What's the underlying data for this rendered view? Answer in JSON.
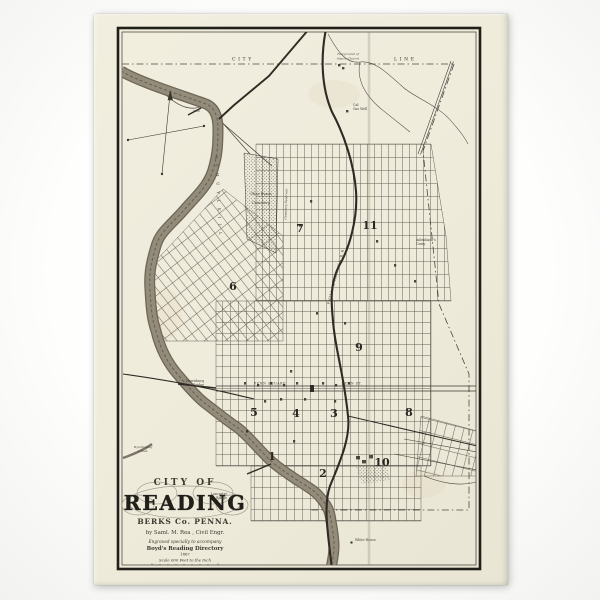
{
  "cartouche": {
    "pretitle": "CITY OF",
    "title": "READING",
    "subtitle": "BERKS Co. PENNA.",
    "byline": "by Saml. M. Rea , Civil Engr.",
    "engraved": "Engraved specially to accompany",
    "directory": "Boyd's Reading Directory",
    "year": "1867",
    "scale": "Scale 600 Feet to the Inch"
  },
  "boundary": {
    "city": "CITY",
    "line": "LINE"
  },
  "wards": {
    "w1": "1",
    "w2": "2",
    "w3": "3",
    "w4": "4",
    "w5": "5",
    "w6": "6",
    "w7": "7",
    "w8": "8",
    "w9": "9",
    "w10": "10",
    "w11": "11"
  },
  "labels": {
    "river": "S C H U Y L K I L L",
    "dam": "Dam",
    "fairground1": "Fairground of",
    "fairground2": "Alsace Church",
    "gas1": "Cal.",
    "gas2": "Gas Well",
    "cemetery1": "Chas Evans",
    "cemetery2": "Cemetery",
    "cemetery_reservoir": "Cemetery Reservoir",
    "aulenbach1": "Aulenbach's",
    "aulenbach2": "Cemy",
    "railroad": "PHILA. & READING R.R.",
    "penn_square": "PENN SQUARE",
    "penn_st": "PENN ST.",
    "harrisburg1": "Harrisburg",
    "harrisburg2": "Bridge",
    "lancaster1": "Lancaster",
    "lancaster2": "Bridge",
    "wyomissing1": "Wyomissing",
    "wyomissing2": "Creek",
    "white_house": "White House"
  },
  "colors": {
    "paper": "#f0ecdc",
    "ink": "#35322b",
    "river": "#948c7b",
    "river_edge": "#6e6757",
    "boundary_line": "#4c4840"
  }
}
